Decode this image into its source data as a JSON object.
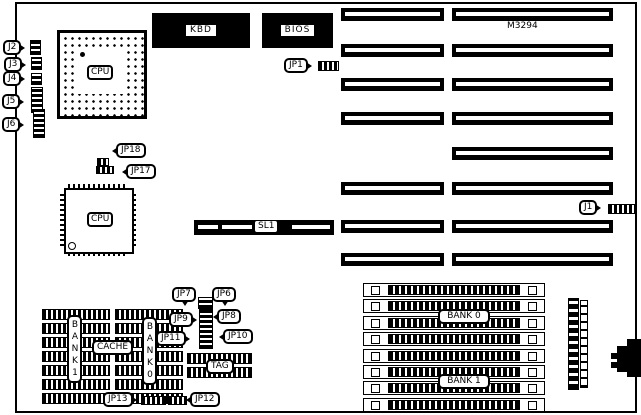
{
  "board": {
    "model": "M3294",
    "chips": {
      "kbd": "KBD",
      "bios": "BIOS",
      "cpu_socket": "CPU",
      "cpu_qfp": "CPU",
      "cache": "CACHE",
      "tag": "TAG",
      "cache_bank1_vertical": "BANK1",
      "cache_bank0_vertical": "BANK0"
    },
    "memory": {
      "simm_bank0": "BANK 0",
      "simm_bank1": "BANK 1"
    },
    "slots": {
      "sl1": "SL1"
    },
    "connectors": {
      "j1": "J1",
      "j2": "J2",
      "j3": "J3",
      "j4": "J4",
      "j5": "J5",
      "j6": "J6"
    },
    "jumpers": {
      "jp1": "JP1",
      "jp6": "JP6",
      "jp7": "JP7",
      "jp8": "JP8",
      "jp9": "JP9",
      "jp10": "JP10",
      "jp11": "JP11",
      "jp12": "JP12",
      "jp13": "JP13",
      "jp17": "JP17",
      "jp18": "JP18"
    },
    "colors": {
      "ink": "#000000",
      "paper": "#ffffff"
    }
  }
}
